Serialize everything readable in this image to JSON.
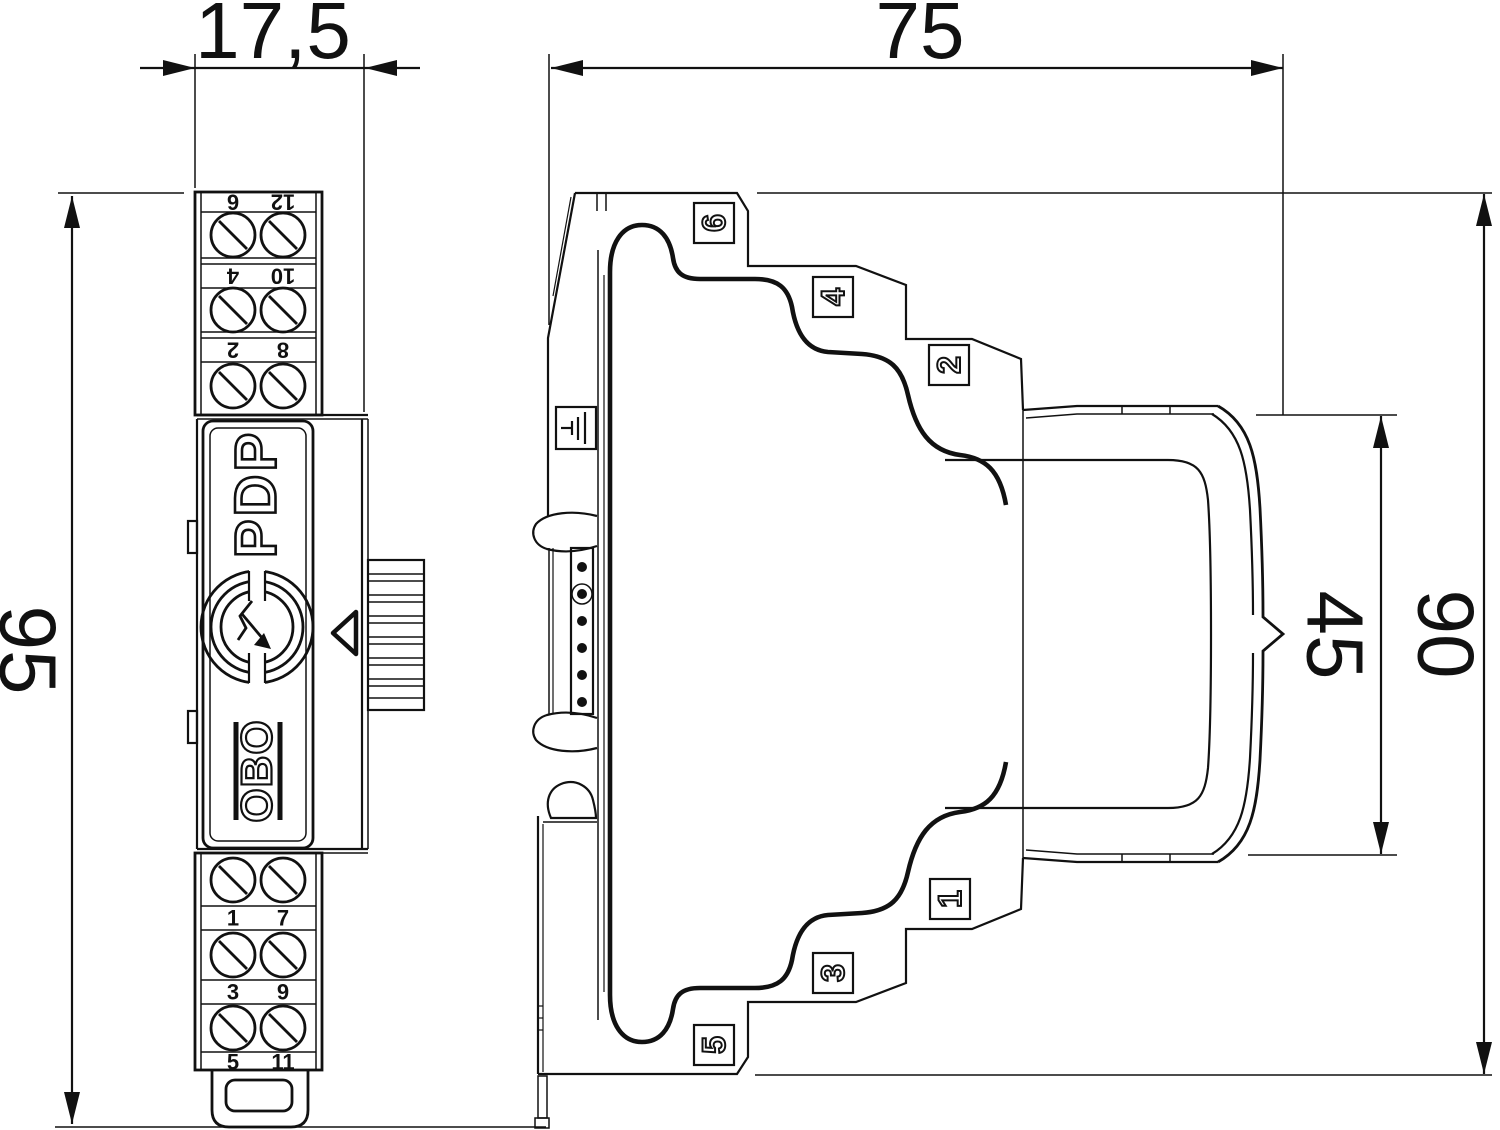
{
  "dims": {
    "width": "17,5",
    "depth": "75",
    "height": "95",
    "plug": "45",
    "body": "90"
  },
  "front": {
    "product": "PDP",
    "brand": "OBO",
    "top_strips": [
      {
        "l": "6",
        "r": "12"
      },
      {
        "l": "4",
        "r": "10"
      },
      {
        "l": "2",
        "r": "8"
      }
    ],
    "bottom_strips": [
      {
        "l": "1",
        "r": "7"
      },
      {
        "l": "3",
        "r": "9"
      },
      {
        "l": "5",
        "r": "11"
      }
    ]
  },
  "side": {
    "top_markers": [
      "6",
      "4",
      "2"
    ],
    "bottom_markers": [
      "1",
      "3",
      "5"
    ]
  },
  "icons": {
    "logo": "surge-protection-logo",
    "earth": "earth-ground-icon",
    "pointer": "triangle-pointer-icon",
    "screw": "screw-terminal-icon"
  },
  "colors": {
    "line": "#111111",
    "background": "#ffffff"
  }
}
